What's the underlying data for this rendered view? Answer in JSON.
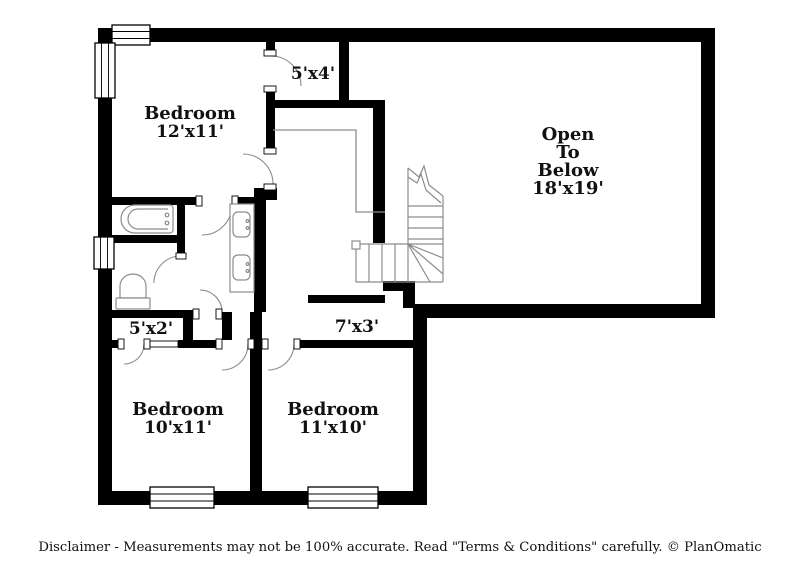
{
  "colors": {
    "background": "#ffffff",
    "wall": "#000000",
    "fixture": "#8c8c8c",
    "text": "#111111"
  },
  "rooms": {
    "bedroom_top": {
      "name": "Bedroom",
      "dims": "12'x11'"
    },
    "closet_top": {
      "dims": "5'x4'"
    },
    "open_below": {
      "line1": "Open",
      "line2": "To",
      "line3": "Below",
      "dims": "18'x19'"
    },
    "closet_mid": {
      "dims": "5'x2'"
    },
    "hall": {
      "dims": "7'x3'"
    },
    "bedroom_left": {
      "name": "Bedroom",
      "dims": "10'x11'"
    },
    "bedroom_right": {
      "name": "Bedroom",
      "dims": "11'x10'"
    }
  },
  "footer": {
    "disclaimer": "Disclaimer - Measurements may not be 100% accurate. Read \"Terms & Conditions\" carefully. © PlanOmatic"
  }
}
